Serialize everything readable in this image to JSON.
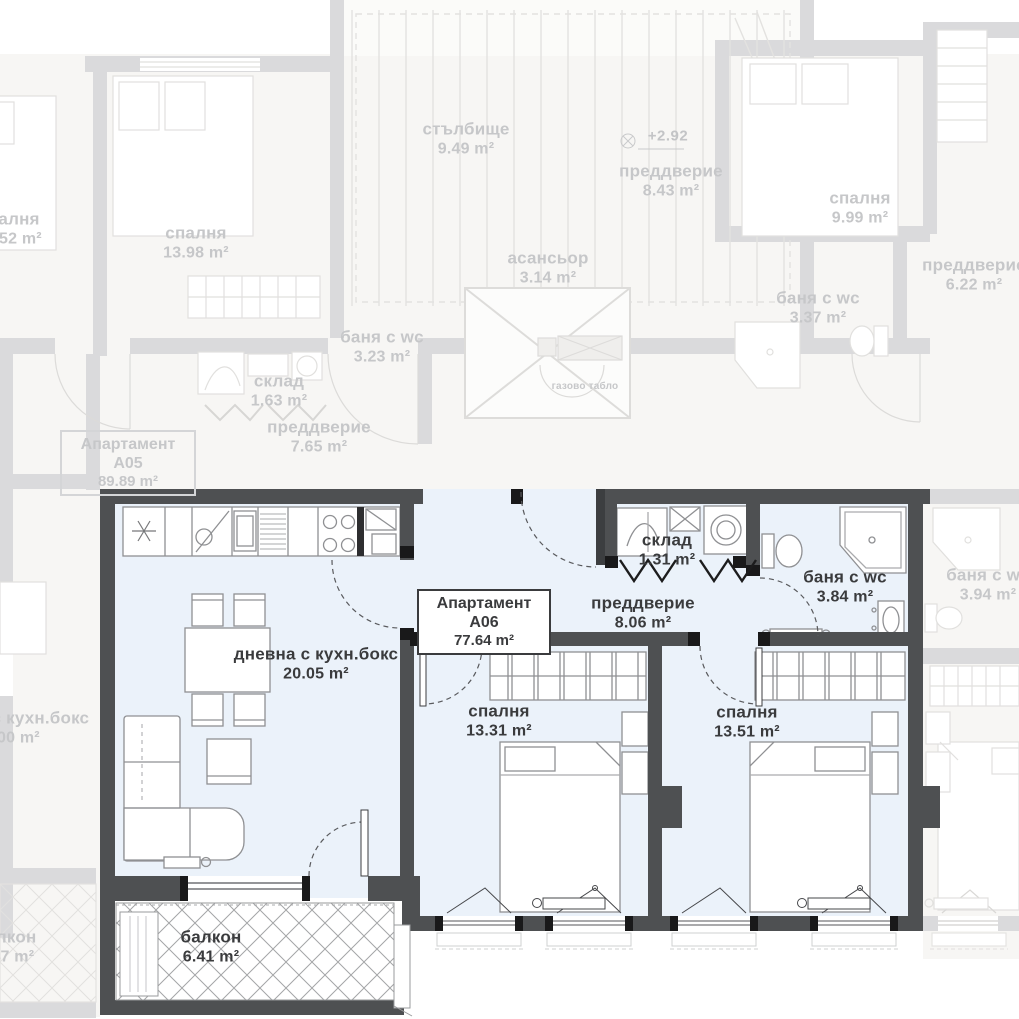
{
  "apartment": {
    "box": {
      "title": "Апартамент А06",
      "area": "77.64 m²"
    },
    "living": {
      "name": "дневна с кухн.бокс",
      "area": "20.05 m²"
    },
    "hallway": {
      "name": "преддверие",
      "area": "8.06 m²"
    },
    "storage": {
      "name": "склад",
      "area": "1.31 m²"
    },
    "bathroom": {
      "name": "баня с wc",
      "area": "3.84 m²"
    },
    "bedroom1": {
      "name": "спалня",
      "area": "13.31 m²"
    },
    "bedroom2": {
      "name": "спалня",
      "area": "13.51 m²"
    },
    "balcony": {
      "name": "балкон",
      "area": "6.41 m²"
    }
  },
  "neighbors": {
    "a05_box": {
      "title": "Апартамент А05",
      "area": "89.89 m²"
    },
    "stairs": {
      "name": "стълбище",
      "area": "9.49 m²"
    },
    "elevator": {
      "name": "асансьор",
      "area": "3.14 m²"
    },
    "level_mark": "+2.92",
    "gas_panel": "газово табло",
    "hall_top": {
      "name": "преддверие",
      "area": "8.43 m²"
    },
    "hall_right": {
      "name": "преддверие",
      "area": "6.22 m²"
    },
    "hall_a05": {
      "name": "преддверие",
      "area": "7.65 m²"
    },
    "bedroom_top_left": {
      "name": "спалня",
      "area": "13.98 m²"
    },
    "bedroom_far_left": {
      "name": "спалня",
      "area": "13.52 m²"
    },
    "bedroom_top_right": {
      "name": "спалня",
      "area": "9.99 m²"
    },
    "bath_a05": {
      "name": "баня с wc",
      "area": "3.23 m²"
    },
    "bath_top_right": {
      "name": "баня с wc",
      "area": "3.37 m²"
    },
    "bath_right": {
      "name": "баня с wc",
      "area": "3.94 m²"
    },
    "storage_a05": {
      "name": "склад",
      "area": "1.63 m²"
    },
    "living_far_left": {
      "name": "дневна с кухн.бокс",
      "area": "20.00 m²"
    },
    "balcony_far_left": {
      "name": "балкон",
      "area": "6.47 m²"
    }
  }
}
